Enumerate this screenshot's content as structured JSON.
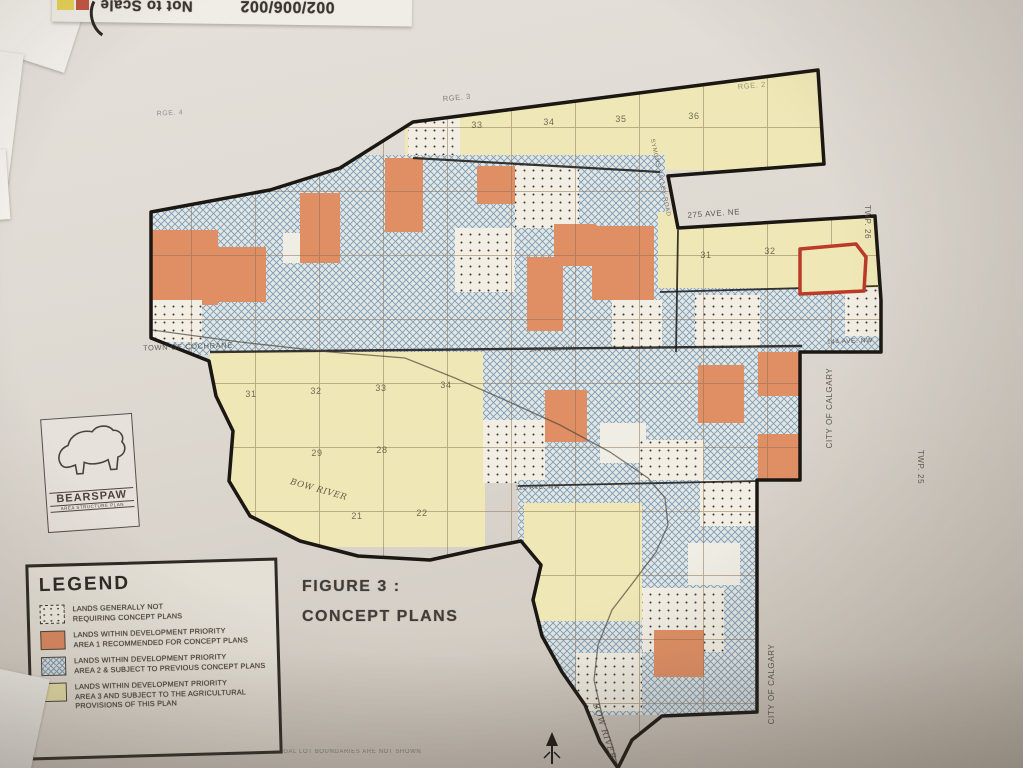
{
  "top_sheet": {
    "scale_note": "Not to Scale",
    "doc_number": "002/006/002"
  },
  "logo": {
    "name": "BEARSPAW",
    "subtitle": "AREA STRUCTURE PLAN"
  },
  "figure": {
    "line1": "FIGURE 3 :",
    "line2": "CONCEPT PLANS"
  },
  "legend": {
    "title": "LEGEND",
    "items": [
      {
        "type": "dots",
        "lines": [
          "LANDS GENERALLY NOT",
          "REQUIRING CONCEPT PLANS"
        ]
      },
      {
        "type": "orange",
        "lines": [
          "LANDS WITHIN DEVELOPMENT PRIORITY",
          "AREA 1 RECOMMENDED FOR CONCEPT PLANS"
        ]
      },
      {
        "type": "hatch",
        "lines": [
          "LANDS WITHIN DEVELOPMENT PRIORITY",
          "AREA 2 & SUBJECT TO PREVIOUS CONCEPT PLANS"
        ]
      },
      {
        "type": "yellow",
        "lines": [
          "LANDS WITHIN DEVELOPMENT PRIORITY",
          "AREA 3 AND SUBJECT TO THE AGRICULTURAL",
          "PROVISIONS OF THIS PLAN"
        ]
      }
    ]
  },
  "map": {
    "colors": {
      "yellow": "#efe8b6",
      "orange": "#e08f64",
      "hatch_base": "#e2e6e4",
      "hatch_line": "#7f9db6",
      "dots_base": "#f2eee3",
      "dot": "#3a3632",
      "white": "#f0ede4",
      "boundary": "#1b1713",
      "grid": "#8a6f52",
      "red_outline": "#bb3a28",
      "river": "#4d473f"
    },
    "boundary": "M 413,122 L 818,70 L 824,164 L 668,176 L 678,228 L 875,216 L 881,300 L 881,352 L 800,352 L 800,480 L 757,480 L 757,712 L 662,716 L 632,740 L 618,768 L 600,742 L 585,705 L 562,672 L 542,636 L 533,600 L 541,565 L 521,541 L 480,549 L 430,560 L 358,556 L 300,541 L 250,516 L 229,481 L 233,431 L 216,396 L 209,361 L 151,338 L 151,212 L 270,190 L 340,168 Z",
    "river": "M 152,330 L 240,342 L 330,352 L 405,358 L 455,378 L 505,400 L 560,425 L 610,452 L 648,478 L 665,498 L 668,525 L 656,552 L 635,580 L 612,610 L 598,645 L 594,680 L 602,715 L 612,745 L 618,768",
    "parcels": [
      {
        "x": 405,
        "y": 60,
        "w": 425,
        "h": 110,
        "t": "y"
      },
      {
        "x": 408,
        "y": 118,
        "w": 52,
        "h": 44,
        "t": "d"
      },
      {
        "x": 150,
        "y": 155,
        "w": 515,
        "h": 200,
        "t": "h"
      },
      {
        "x": 658,
        "y": 212,
        "w": 222,
        "h": 145,
        "t": "y"
      },
      {
        "x": 658,
        "y": 288,
        "w": 222,
        "h": 70,
        "t": "h"
      },
      {
        "x": 695,
        "y": 295,
        "w": 65,
        "h": 55,
        "t": "d"
      },
      {
        "x": 845,
        "y": 288,
        "w": 40,
        "h": 48,
        "t": "d"
      },
      {
        "x": 150,
        "y": 230,
        "w": 68,
        "h": 75,
        "t": "o"
      },
      {
        "x": 218,
        "y": 247,
        "w": 48,
        "h": 55,
        "t": "o"
      },
      {
        "x": 152,
        "y": 300,
        "w": 50,
        "h": 42,
        "t": "d"
      },
      {
        "x": 283,
        "y": 233,
        "w": 42,
        "h": 30,
        "t": "w"
      },
      {
        "x": 300,
        "y": 193,
        "w": 40,
        "h": 70,
        "t": "o"
      },
      {
        "x": 385,
        "y": 158,
        "w": 38,
        "h": 74,
        "t": "o"
      },
      {
        "x": 477,
        "y": 166,
        "w": 40,
        "h": 38,
        "t": "o"
      },
      {
        "x": 515,
        "y": 166,
        "w": 64,
        "h": 62,
        "t": "d"
      },
      {
        "x": 455,
        "y": 228,
        "w": 60,
        "h": 64,
        "t": "d"
      },
      {
        "x": 554,
        "y": 224,
        "w": 42,
        "h": 42,
        "t": "o"
      },
      {
        "x": 527,
        "y": 257,
        "w": 36,
        "h": 74,
        "t": "o"
      },
      {
        "x": 592,
        "y": 226,
        "w": 62,
        "h": 74,
        "t": "o"
      },
      {
        "x": 612,
        "y": 300,
        "w": 50,
        "h": 52,
        "t": "d"
      },
      {
        "x": 210,
        "y": 352,
        "w": 275,
        "h": 195,
        "t": "y"
      },
      {
        "x": 483,
        "y": 348,
        "w": 320,
        "h": 135,
        "t": "h"
      },
      {
        "x": 545,
        "y": 390,
        "w": 42,
        "h": 52,
        "t": "o"
      },
      {
        "x": 600,
        "y": 423,
        "w": 46,
        "h": 40,
        "t": "w"
      },
      {
        "x": 483,
        "y": 420,
        "w": 62,
        "h": 63,
        "t": "d"
      },
      {
        "x": 640,
        "y": 440,
        "w": 64,
        "h": 44,
        "t": "d"
      },
      {
        "x": 698,
        "y": 365,
        "w": 46,
        "h": 58,
        "t": "o"
      },
      {
        "x": 758,
        "y": 352,
        "w": 44,
        "h": 44,
        "t": "o"
      },
      {
        "x": 758,
        "y": 434,
        "w": 44,
        "h": 48,
        "t": "o"
      },
      {
        "x": 518,
        "y": 480,
        "w": 242,
        "h": 235,
        "t": "h"
      },
      {
        "x": 524,
        "y": 503,
        "w": 118,
        "h": 118,
        "t": "y"
      },
      {
        "x": 700,
        "y": 480,
        "w": 58,
        "h": 46,
        "t": "d"
      },
      {
        "x": 688,
        "y": 543,
        "w": 52,
        "h": 42,
        "t": "w"
      },
      {
        "x": 642,
        "y": 588,
        "w": 82,
        "h": 64,
        "t": "d"
      },
      {
        "x": 576,
        "y": 653,
        "w": 66,
        "h": 58,
        "t": "d"
      },
      {
        "x": 654,
        "y": 630,
        "w": 50,
        "h": 47,
        "t": "o"
      }
    ],
    "highlight_parcel": {
      "points": "800,249 856,244 866,257 864,291 800,294"
    },
    "lines": [
      {
        "x1": 413,
        "y1": 158,
        "x2": 660,
        "y2": 172,
        "w": 2.2
      },
      {
        "x1": 660,
        "y1": 292,
        "x2": 878,
        "y2": 286,
        "w": 1.8
      },
      {
        "x1": 210,
        "y1": 352,
        "x2": 802,
        "y2": 346,
        "w": 2.4
      },
      {
        "x1": 518,
        "y1": 486,
        "x2": 757,
        "y2": 481,
        "w": 1.8
      },
      {
        "x1": 678,
        "y1": 230,
        "x2": 676,
        "y2": 352,
        "w": 1.8
      }
    ],
    "labels": [
      {
        "text": "RGE. 4",
        "x": 170,
        "y": 115,
        "s": 7,
        "r": -3,
        "o": 0.5
      },
      {
        "text": "RGE. 3",
        "x": 457,
        "y": 100,
        "s": 7.5,
        "r": -5,
        "o": 0.6
      },
      {
        "text": "RGE. 2",
        "x": 752,
        "y": 88,
        "s": 7.5,
        "r": -5,
        "o": 0.5
      },
      {
        "text": "TWP. 26",
        "x": 865,
        "y": 222,
        "s": 8,
        "r": 90,
        "o": 0.8
      },
      {
        "text": "TWP. 25",
        "x": 918,
        "y": 467,
        "s": 8,
        "r": 90,
        "o": 0.8
      },
      {
        "text": "275 AVE. NE",
        "x": 714,
        "y": 216,
        "s": 8,
        "r": -4,
        "o": 0.85
      },
      {
        "text": "SYMONS VALLEY ROAD",
        "x": 659,
        "y": 178,
        "s": 6,
        "r": 78,
        "o": 0.7
      },
      {
        "text": "TOWN OF COCHRANE",
        "x": 188,
        "y": 349,
        "s": 7.5,
        "r": -2,
        "o": 0.8
      },
      {
        "text": "144 AVE. NW",
        "x": 552,
        "y": 351,
        "s": 6.5,
        "r": -2,
        "o": 0.8
      },
      {
        "text": "144 AVE. NW",
        "x": 850,
        "y": 343,
        "s": 6.5,
        "r": -2,
        "o": 0.8
      },
      {
        "text": "112 AVE. NW",
        "x": 538,
        "y": 489,
        "s": 6.5,
        "r": -2,
        "o": 0.8
      },
      {
        "text": "CITY OF CALGARY",
        "x": 832,
        "y": 408,
        "s": 8,
        "r": -90,
        "o": 0.85
      },
      {
        "text": "CITY OF CALGARY",
        "x": 774,
        "y": 684,
        "s": 8,
        "r": -90,
        "o": 0.85
      },
      {
        "text": "BOW RIVER",
        "x": 318,
        "y": 492,
        "s": 8.5,
        "r": 16,
        "o": 0.85,
        "i": 1
      },
      {
        "text": "BOW RIVER",
        "x": 602,
        "y": 732,
        "s": 8.5,
        "r": 72,
        "o": 0.85,
        "i": 1
      },
      {
        "text": "LEGAL LOT BOUNDARIES ARE NOT SHOWN",
        "x": 348,
        "y": 753,
        "s": 6,
        "r": 0,
        "o": 0.55
      }
    ],
    "section_numbers": [
      {
        "n": "33",
        "x": 477,
        "y": 128
      },
      {
        "n": "34",
        "x": 549,
        "y": 125
      },
      {
        "n": "35",
        "x": 621,
        "y": 122
      },
      {
        "n": "36",
        "x": 694,
        "y": 119
      },
      {
        "n": "31",
        "x": 706,
        "y": 258
      },
      {
        "n": "32",
        "x": 770,
        "y": 254
      },
      {
        "n": "31",
        "x": 251,
        "y": 397
      },
      {
        "n": "32",
        "x": 316,
        "y": 394
      },
      {
        "n": "33",
        "x": 381,
        "y": 391
      },
      {
        "n": "34",
        "x": 446,
        "y": 388
      },
      {
        "n": "29",
        "x": 317,
        "y": 456
      },
      {
        "n": "28",
        "x": 382,
        "y": 453
      },
      {
        "n": "21",
        "x": 357,
        "y": 519
      },
      {
        "n": "22",
        "x": 422,
        "y": 516
      }
    ],
    "north_arrow": {
      "x": 552,
      "y": 748
    }
  }
}
